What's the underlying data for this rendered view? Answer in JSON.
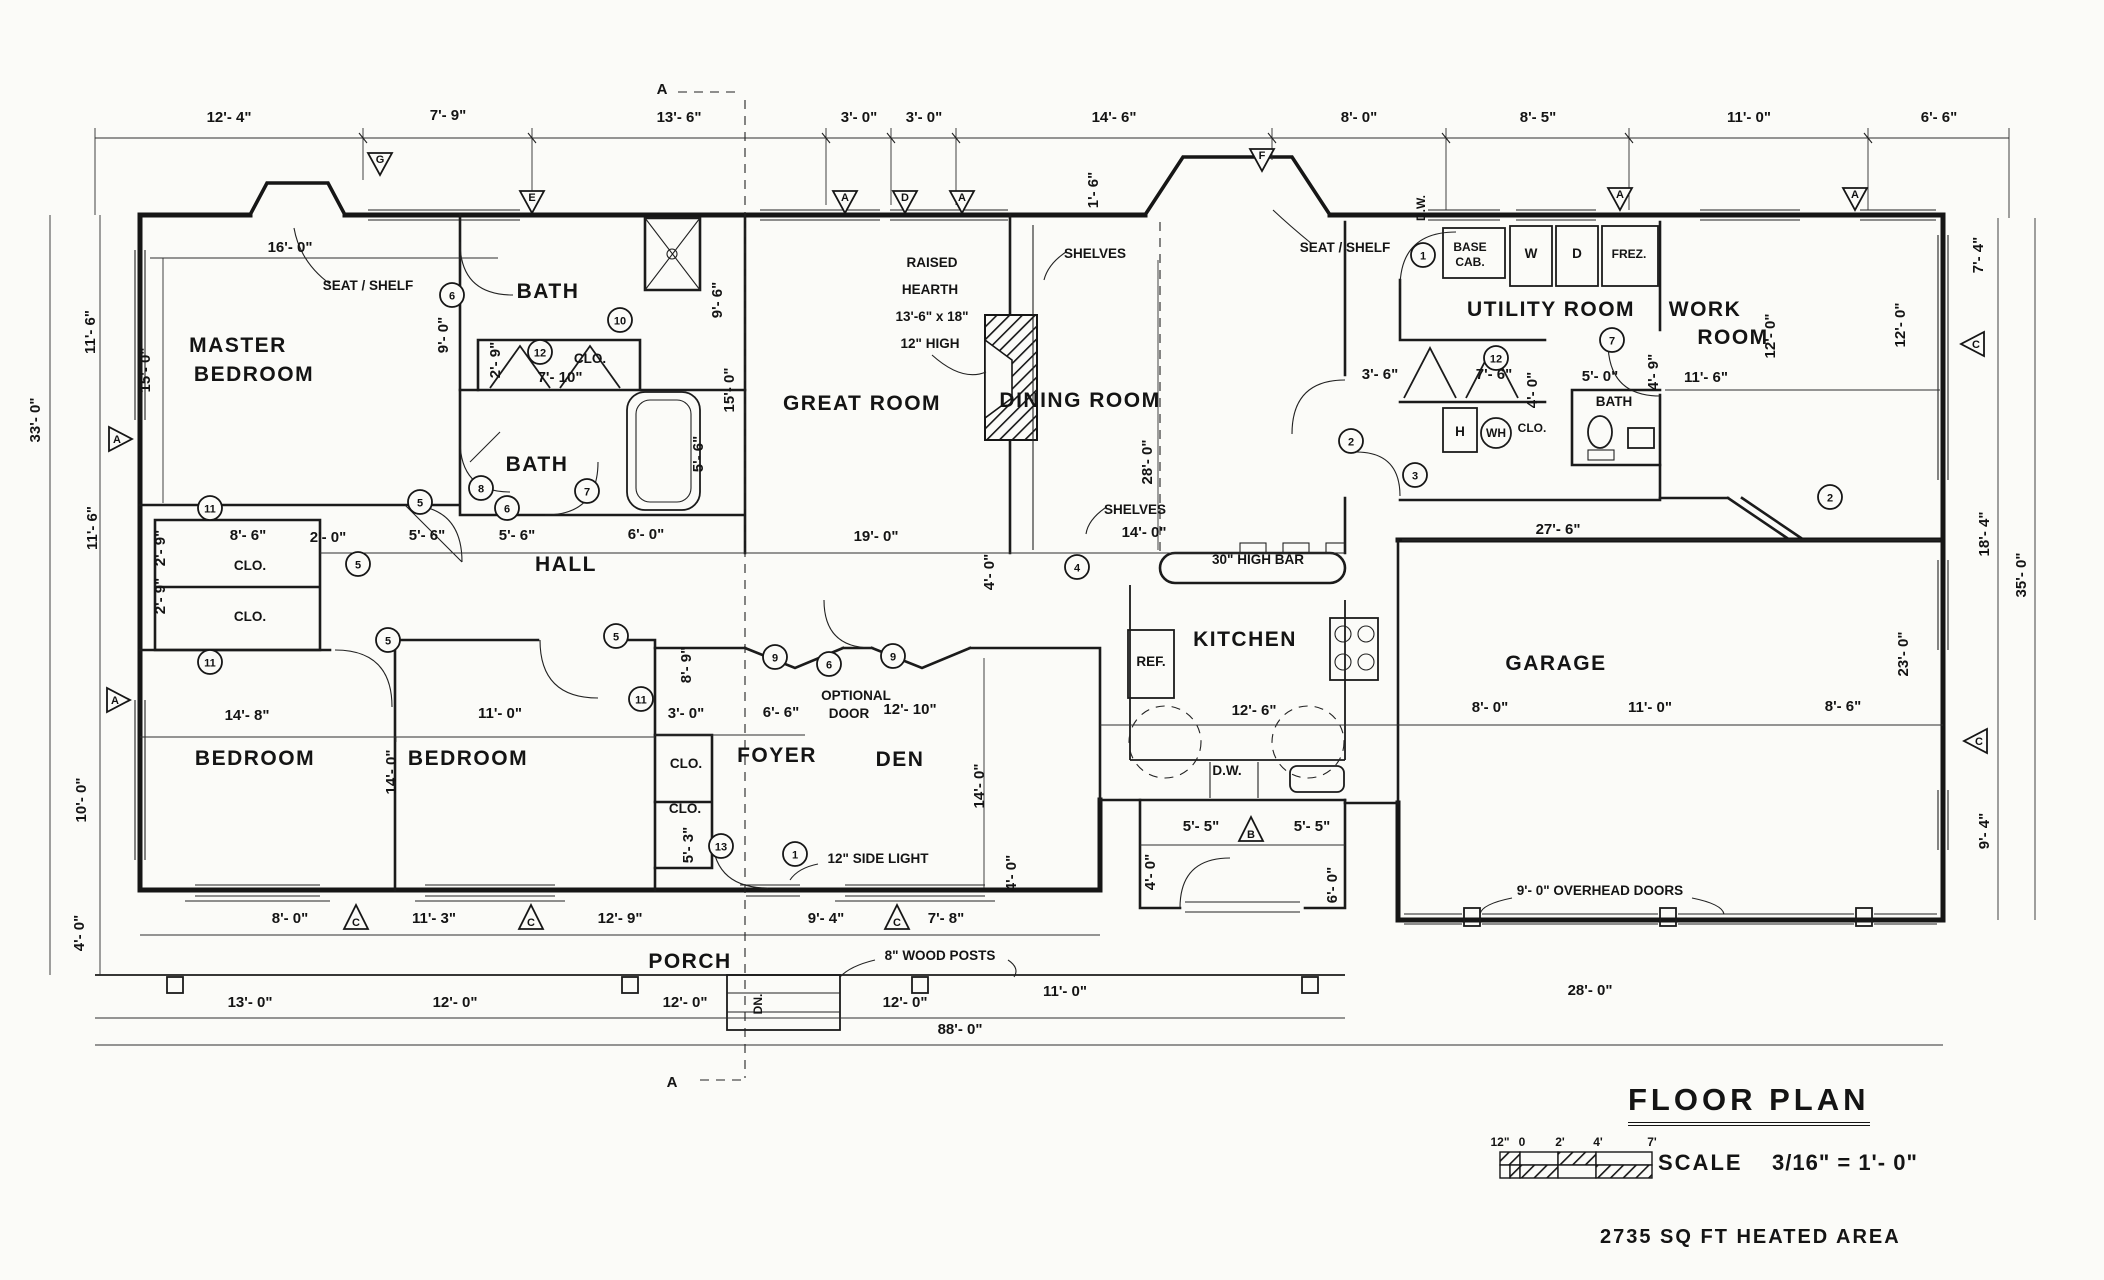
{
  "titleblock": {
    "title": "FLOOR PLAN",
    "scale_label": "SCALE",
    "scale_value": "3/16\" = 1'- 0\"",
    "area_note": "2735 SQ FT HEATED AREA"
  },
  "scalebar": {
    "ticks": [
      {
        "t": "12\"",
        "x": 1500
      },
      {
        "t": "0",
        "x": 1522
      },
      {
        "t": "2'",
        "x": 1560
      },
      {
        "t": "4'",
        "x": 1598
      },
      {
        "t": "7'",
        "x": 1652
      }
    ]
  },
  "texts": [
    {
      "t": "12'- 4\"",
      "x": 229,
      "y": 122,
      "c": "dim"
    },
    {
      "t": "7'- 9\"",
      "x": 448,
      "y": 120,
      "c": "dim"
    },
    {
      "t": "13'- 6\"",
      "x": 679,
      "y": 122,
      "c": "dim"
    },
    {
      "t": "3'- 0\"",
      "x": 859,
      "y": 122,
      "c": "dim"
    },
    {
      "t": "3'- 0\"",
      "x": 924,
      "y": 122,
      "c": "dim"
    },
    {
      "t": "14'- 6\"",
      "x": 1114,
      "y": 122,
      "c": "dim"
    },
    {
      "t": "8'- 0\"",
      "x": 1359,
      "y": 122,
      "c": "dim"
    },
    {
      "t": "8'- 5\"",
      "x": 1538,
      "y": 122,
      "c": "dim"
    },
    {
      "t": "11'- 0\"",
      "x": 1749,
      "y": 122,
      "c": "dim"
    },
    {
      "t": "6'- 6\"",
      "x": 1939,
      "y": 122,
      "c": "dim"
    },
    {
      "t": "16'- 0\"",
      "x": 290,
      "y": 252,
      "c": "dim"
    },
    {
      "t": "1'- 6\"",
      "x": 1098,
      "y": 190,
      "r": 1,
      "c": "dim"
    },
    {
      "t": "D.W.",
      "x": 1425,
      "y": 208,
      "r": 1,
      "c": "small"
    },
    {
      "t": "11'- 6\"",
      "x": 95,
      "y": 332,
      "r": 1,
      "c": "dim"
    },
    {
      "t": "33'- 0\"",
      "x": 40,
      "y": 420,
      "r": 1,
      "c": "dim"
    },
    {
      "t": "11'- 6\"",
      "x": 97,
      "y": 528,
      "r": 1,
      "c": "dim"
    },
    {
      "t": "15'- 0\"",
      "x": 150,
      "y": 370,
      "r": 1,
      "c": "dim"
    },
    {
      "t": "10'- 0\"",
      "x": 86,
      "y": 800,
      "r": 1,
      "c": "dim"
    },
    {
      "t": "4'- 0\"",
      "x": 84,
      "y": 933,
      "r": 1,
      "c": "dim"
    },
    {
      "t": "7'- 4\"",
      "x": 1983,
      "y": 255,
      "r": 1,
      "c": "dim"
    },
    {
      "t": "12'- 0\"",
      "x": 1905,
      "y": 325,
      "r": 1,
      "c": "dim"
    },
    {
      "t": "18'- 4\"",
      "x": 1989,
      "y": 534,
      "r": 1,
      "c": "dim"
    },
    {
      "t": "35'- 0\"",
      "x": 2026,
      "y": 575,
      "r": 1,
      "c": "dim"
    },
    {
      "t": "23'- 0\"",
      "x": 1908,
      "y": 654,
      "r": 1,
      "c": "dim"
    },
    {
      "t": "9'- 4\"",
      "x": 1989,
      "y": 831,
      "r": 1,
      "c": "dim"
    },
    {
      "t": "MASTER",
      "n": "room-master-bedroom",
      "x": 238,
      "y": 352,
      "c": "room"
    },
    {
      "t": "BEDROOM",
      "n": "room-master-bedroom",
      "x": 254,
      "y": 381,
      "c": "room"
    },
    {
      "t": "SEAT / SHELF",
      "x": 368,
      "y": 290,
      "c": "note"
    },
    {
      "t": "BATH",
      "n": "room-bath-1",
      "x": 548,
      "y": 298,
      "c": "room"
    },
    {
      "t": "9'- 0\"",
      "x": 448,
      "y": 335,
      "r": 1,
      "c": "dim"
    },
    {
      "t": "9'- 6\"",
      "x": 722,
      "y": 300,
      "r": 1,
      "c": "dim"
    },
    {
      "t": "2'- 9\"",
      "x": 500,
      "y": 360,
      "r": 1,
      "c": "dim"
    },
    {
      "t": "CLO.",
      "x": 590,
      "y": 363,
      "c": "note"
    },
    {
      "t": "7'- 10\"",
      "x": 560,
      "y": 382,
      "c": "dim"
    },
    {
      "t": "BATH",
      "n": "room-bath-2",
      "x": 537,
      "y": 471,
      "c": "room"
    },
    {
      "t": "5'- 6\"",
      "x": 703,
      "y": 454,
      "r": 1,
      "c": "dim"
    },
    {
      "t": "15'- 0\"",
      "x": 734,
      "y": 390,
      "r": 1,
      "c": "dim"
    },
    {
      "t": "8'- 6\"",
      "x": 248,
      "y": 540,
      "c": "dim"
    },
    {
      "t": "CLO.",
      "x": 250,
      "y": 570,
      "c": "note"
    },
    {
      "t": "CLO.",
      "x": 250,
      "y": 621,
      "c": "note"
    },
    {
      "t": "2'- 9\"",
      "x": 165,
      "y": 548,
      "r": 1,
      "c": "dim"
    },
    {
      "t": "2'- 9\"",
      "x": 165,
      "y": 596,
      "r": 1,
      "c": "dim"
    },
    {
      "t": "2'- 0\"",
      "x": 328,
      "y": 542,
      "c": "dim"
    },
    {
      "t": "5'- 6\"",
      "x": 427,
      "y": 540,
      "c": "dim"
    },
    {
      "t": "5'- 6\"",
      "x": 517,
      "y": 540,
      "c": "dim"
    },
    {
      "t": "6'- 0\"",
      "x": 646,
      "y": 539,
      "c": "dim"
    },
    {
      "t": "HALL",
      "n": "room-hall",
      "x": 566,
      "y": 571,
      "c": "room"
    },
    {
      "t": "GREAT ROOM",
      "n": "room-great-room",
      "x": 862,
      "y": 410,
      "c": "room"
    },
    {
      "t": "19'- 0\"",
      "x": 876,
      "y": 541,
      "c": "dim"
    },
    {
      "t": "RAISED",
      "x": 932,
      "y": 267,
      "c": "note"
    },
    {
      "t": "HEARTH",
      "x": 930,
      "y": 294,
      "c": "note"
    },
    {
      "t": "13'-6\" x 18\"",
      "x": 932,
      "y": 321,
      "c": "note"
    },
    {
      "t": "12\" HIGH",
      "x": 930,
      "y": 348,
      "c": "note"
    },
    {
      "t": "SHELVES",
      "x": 1095,
      "y": 258,
      "c": "note"
    },
    {
      "t": "SEAT / SHELF",
      "x": 1345,
      "y": 252,
      "c": "note"
    },
    {
      "t": "DINING ROOM",
      "n": "room-dining-room",
      "x": 1080,
      "y": 407,
      "c": "room"
    },
    {
      "t": "28'- 0\"",
      "x": 1152,
      "y": 462,
      "r": 1,
      "c": "dim"
    },
    {
      "t": "SHELVES",
      "x": 1135,
      "y": 514,
      "c": "note"
    },
    {
      "t": "14'- 0\"",
      "x": 1144,
      "y": 537,
      "c": "dim"
    },
    {
      "t": "4'- 0\"",
      "x": 994,
      "y": 572,
      "r": 1,
      "c": "dim"
    },
    {
      "t": "30\" HIGH BAR",
      "x": 1258,
      "y": 564,
      "c": "note"
    },
    {
      "t": "KITCHEN",
      "n": "room-kitchen",
      "x": 1245,
      "y": 646,
      "c": "room"
    },
    {
      "t": "REF.",
      "x": 1151,
      "y": 666,
      "c": "note"
    },
    {
      "t": "12'- 6\"",
      "x": 1254,
      "y": 715,
      "c": "dim"
    },
    {
      "t": "D.W.",
      "x": 1227,
      "y": 775,
      "c": "note"
    },
    {
      "t": "3'- 6\"",
      "x": 1380,
      "y": 379,
      "c": "dim"
    },
    {
      "t": "BASE",
      "x": 1470,
      "y": 251,
      "c": "small"
    },
    {
      "t": "CAB.",
      "x": 1470,
      "y": 266,
      "c": "small"
    },
    {
      "t": "W",
      "x": 1531,
      "y": 258,
      "c": "note"
    },
    {
      "t": "D",
      "x": 1577,
      "y": 258,
      "c": "note"
    },
    {
      "t": "FREZ.",
      "x": 1629,
      "y": 258,
      "c": "small"
    },
    {
      "t": "UTILITY ROOM",
      "n": "room-utility-room",
      "x": 1551,
      "y": 316,
      "c": "room"
    },
    {
      "t": "7'- 6\"",
      "x": 1494,
      "y": 379,
      "c": "dim"
    },
    {
      "t": "4'- 0\"",
      "x": 1537,
      "y": 390,
      "r": 1,
      "c": "dim"
    },
    {
      "t": "H",
      "x": 1460,
      "y": 436,
      "c": "note"
    },
    {
      "t": "WH",
      "x": 1496,
      "y": 437,
      "c": "small"
    },
    {
      "t": "CLO.",
      "x": 1532,
      "y": 432,
      "c": "small"
    },
    {
      "t": "5'- 0\"",
      "x": 1600,
      "y": 381,
      "c": "dim"
    },
    {
      "t": "BATH",
      "n": "room-bath-3",
      "x": 1614,
      "y": 406,
      "c": "note"
    },
    {
      "t": "4'- 9\"",
      "x": 1658,
      "y": 372,
      "r": 1,
      "c": "dim"
    },
    {
      "t": "WORK",
      "n": "room-work-room",
      "x": 1705,
      "y": 316,
      "c": "room"
    },
    {
      "t": "ROOM",
      "n": "room-work-room",
      "x": 1733,
      "y": 344,
      "c": "room"
    },
    {
      "t": "11'- 6\"",
      "x": 1706,
      "y": 382,
      "c": "dim"
    },
    {
      "t": "12'- 0\"",
      "x": 1775,
      "y": 336,
      "r": 1,
      "c": "dim"
    },
    {
      "t": "27'- 6\"",
      "x": 1558,
      "y": 534,
      "c": "dim"
    },
    {
      "t": "GARAGE",
      "n": "room-garage",
      "x": 1556,
      "y": 670,
      "c": "room"
    },
    {
      "t": "8'- 0\"",
      "x": 1490,
      "y": 712,
      "c": "dim"
    },
    {
      "t": "11'- 0\"",
      "x": 1650,
      "y": 712,
      "c": "dim"
    },
    {
      "t": "8'- 6\"",
      "x": 1843,
      "y": 711,
      "c": "dim"
    },
    {
      "t": "9'- 0\" OVERHEAD DOORS",
      "x": 1600,
      "y": 895,
      "c": "note"
    },
    {
      "t": "28'- 0\"",
      "x": 1590,
      "y": 995,
      "c": "dim"
    },
    {
      "t": "BEDROOM",
      "n": "room-bedroom-1",
      "x": 255,
      "y": 765,
      "c": "room"
    },
    {
      "t": "14'- 8\"",
      "x": 247,
      "y": 720,
      "c": "dim"
    },
    {
      "t": "14'- 0\"",
      "x": 396,
      "y": 772,
      "r": 1,
      "c": "dim"
    },
    {
      "t": "BEDROOM",
      "n": "room-bedroom-2",
      "x": 468,
      "y": 765,
      "c": "room"
    },
    {
      "t": "11'- 0\"",
      "x": 500,
      "y": 718,
      "c": "dim"
    },
    {
      "t": "8'- 9\"",
      "x": 691,
      "y": 665,
      "r": 1,
      "c": "dim"
    },
    {
      "t": "3'- 0\"",
      "x": 686,
      "y": 718,
      "c": "dim"
    },
    {
      "t": "CLO.",
      "x": 686,
      "y": 768,
      "c": "note"
    },
    {
      "t": "CLO.",
      "x": 685,
      "y": 813,
      "c": "note"
    },
    {
      "t": "5'- 3\"",
      "x": 693,
      "y": 845,
      "r": 1,
      "c": "dim"
    },
    {
      "t": "FOYER",
      "n": "room-foyer",
      "x": 777,
      "y": 762,
      "c": "room"
    },
    {
      "t": "6'- 6\"",
      "x": 781,
      "y": 717,
      "c": "dim"
    },
    {
      "t": "OPTIONAL",
      "x": 856,
      "y": 700,
      "c": "note"
    },
    {
      "t": "DOOR",
      "x": 849,
      "y": 718,
      "c": "note"
    },
    {
      "t": "12'- 10\"",
      "x": 910,
      "y": 714,
      "c": "dim"
    },
    {
      "t": "DEN",
      "n": "room-den",
      "x": 900,
      "y": 766,
      "c": "room"
    },
    {
      "t": "14'- 0\"",
      "x": 984,
      "y": 786,
      "r": 1,
      "c": "dim"
    },
    {
      "t": "12\" SIDE LIGHT",
      "x": 878,
      "y": 863,
      "c": "note"
    },
    {
      "t": "4'- 0\"",
      "x": 1016,
      "y": 873,
      "r": 1,
      "c": "dim"
    },
    {
      "t": "5'- 5\"",
      "x": 1201,
      "y": 831,
      "c": "dim"
    },
    {
      "t": "5'- 5\"",
      "x": 1312,
      "y": 831,
      "c": "dim"
    },
    {
      "t": "4'- 0\"",
      "x": 1155,
      "y": 872,
      "r": 1,
      "c": "dim"
    },
    {
      "t": "6'- 0\"",
      "x": 1337,
      "y": 885,
      "r": 1,
      "c": "dim"
    },
    {
      "t": "8'- 0\"",
      "x": 290,
      "y": 923,
      "c": "dim"
    },
    {
      "t": "11'- 3\"",
      "x": 434,
      "y": 923,
      "c": "dim"
    },
    {
      "t": "12'- 9\"",
      "x": 620,
      "y": 923,
      "c": "dim"
    },
    {
      "t": "9'- 4\"",
      "x": 826,
      "y": 923,
      "c": "dim"
    },
    {
      "t": "7'- 8\"",
      "x": 946,
      "y": 923,
      "c": "dim"
    },
    {
      "t": "PORCH",
      "n": "room-porch",
      "x": 690,
      "y": 968,
      "c": "room"
    },
    {
      "t": "8\" WOOD POSTS",
      "x": 940,
      "y": 960,
      "c": "note"
    },
    {
      "t": "DN.",
      "x": 762,
      "y": 1004,
      "r": 1,
      "c": "small"
    },
    {
      "t": "13'- 0\"",
      "x": 250,
      "y": 1007,
      "c": "dim"
    },
    {
      "t": "12'- 0\"",
      "x": 455,
      "y": 1007,
      "c": "dim"
    },
    {
      "t": "12'- 0\"",
      "x": 685,
      "y": 1007,
      "c": "dim"
    },
    {
      "t": "12'- 0\"",
      "x": 905,
      "y": 1007,
      "c": "dim"
    },
    {
      "t": "11'- 0\"",
      "x": 1065,
      "y": 996,
      "c": "dim"
    },
    {
      "t": "88'- 0\"",
      "x": 960,
      "y": 1034,
      "c": "dim"
    },
    {
      "t": "A",
      "x": 662,
      "y": 94,
      "c": "dim"
    },
    {
      "t": "A",
      "x": 672,
      "y": 1087,
      "c": "dim"
    }
  ],
  "circles": [
    {
      "n": "1",
      "x": 1423,
      "y": 255
    },
    {
      "n": "1",
      "x": 795,
      "y": 854
    },
    {
      "n": "2",
      "x": 1351,
      "y": 441
    },
    {
      "n": "2",
      "x": 1830,
      "y": 497
    },
    {
      "n": "3",
      "x": 1415,
      "y": 475
    },
    {
      "n": "4",
      "x": 1077,
      "y": 567
    },
    {
      "n": "5",
      "x": 420,
      "y": 502
    },
    {
      "n": "5",
      "x": 358,
      "y": 564
    },
    {
      "n": "5",
      "x": 388,
      "y": 640
    },
    {
      "n": "5",
      "x": 616,
      "y": 636
    },
    {
      "n": "6",
      "x": 452,
      "y": 295
    },
    {
      "n": "6",
      "x": 507,
      "y": 508
    },
    {
      "n": "6",
      "x": 829,
      "y": 664
    },
    {
      "n": "7",
      "x": 587,
      "y": 491
    },
    {
      "n": "7",
      "x": 1612,
      "y": 340
    },
    {
      "n": "8",
      "x": 481,
      "y": 488
    },
    {
      "n": "9",
      "x": 775,
      "y": 657
    },
    {
      "n": "9",
      "x": 893,
      "y": 656
    },
    {
      "n": "10",
      "x": 620,
      "y": 320
    },
    {
      "n": "11",
      "x": 210,
      "y": 508
    },
    {
      "n": "11",
      "x": 210,
      "y": 662
    },
    {
      "n": "11",
      "x": 641,
      "y": 699
    },
    {
      "n": "12",
      "x": 540,
      "y": 352
    },
    {
      "n": "12",
      "x": 1496,
      "y": 358
    },
    {
      "n": "13",
      "x": 721,
      "y": 846
    }
  ],
  "triangles": [
    {
      "t": "G",
      "x": 380,
      "y": 162,
      "d": "down"
    },
    {
      "t": "E",
      "x": 532,
      "y": 200,
      "d": "down"
    },
    {
      "t": "A",
      "x": 845,
      "y": 200,
      "d": "down"
    },
    {
      "t": "D",
      "x": 905,
      "y": 200,
      "d": "down"
    },
    {
      "t": "A",
      "x": 962,
      "y": 200,
      "d": "down"
    },
    {
      "t": "F",
      "x": 1262,
      "y": 158,
      "d": "down"
    },
    {
      "t": "A",
      "x": 1620,
      "y": 197,
      "d": "down"
    },
    {
      "t": "A",
      "x": 1855,
      "y": 197,
      "d": "down"
    },
    {
      "t": "A",
      "x": 119,
      "y": 439,
      "d": "right"
    },
    {
      "t": "A",
      "x": 117,
      "y": 700,
      "d": "right"
    },
    {
      "t": "C",
      "x": 1974,
      "y": 344,
      "d": "left"
    },
    {
      "t": "C",
      "x": 1977,
      "y": 741,
      "d": "left"
    },
    {
      "t": "C",
      "x": 356,
      "y": 918,
      "d": "up"
    },
    {
      "t": "C",
      "x": 531,
      "y": 918,
      "d": "up"
    },
    {
      "t": "C",
      "x": 897,
      "y": 918,
      "d": "up"
    },
    {
      "t": "B",
      "x": 1251,
      "y": 830,
      "d": "up"
    }
  ]
}
